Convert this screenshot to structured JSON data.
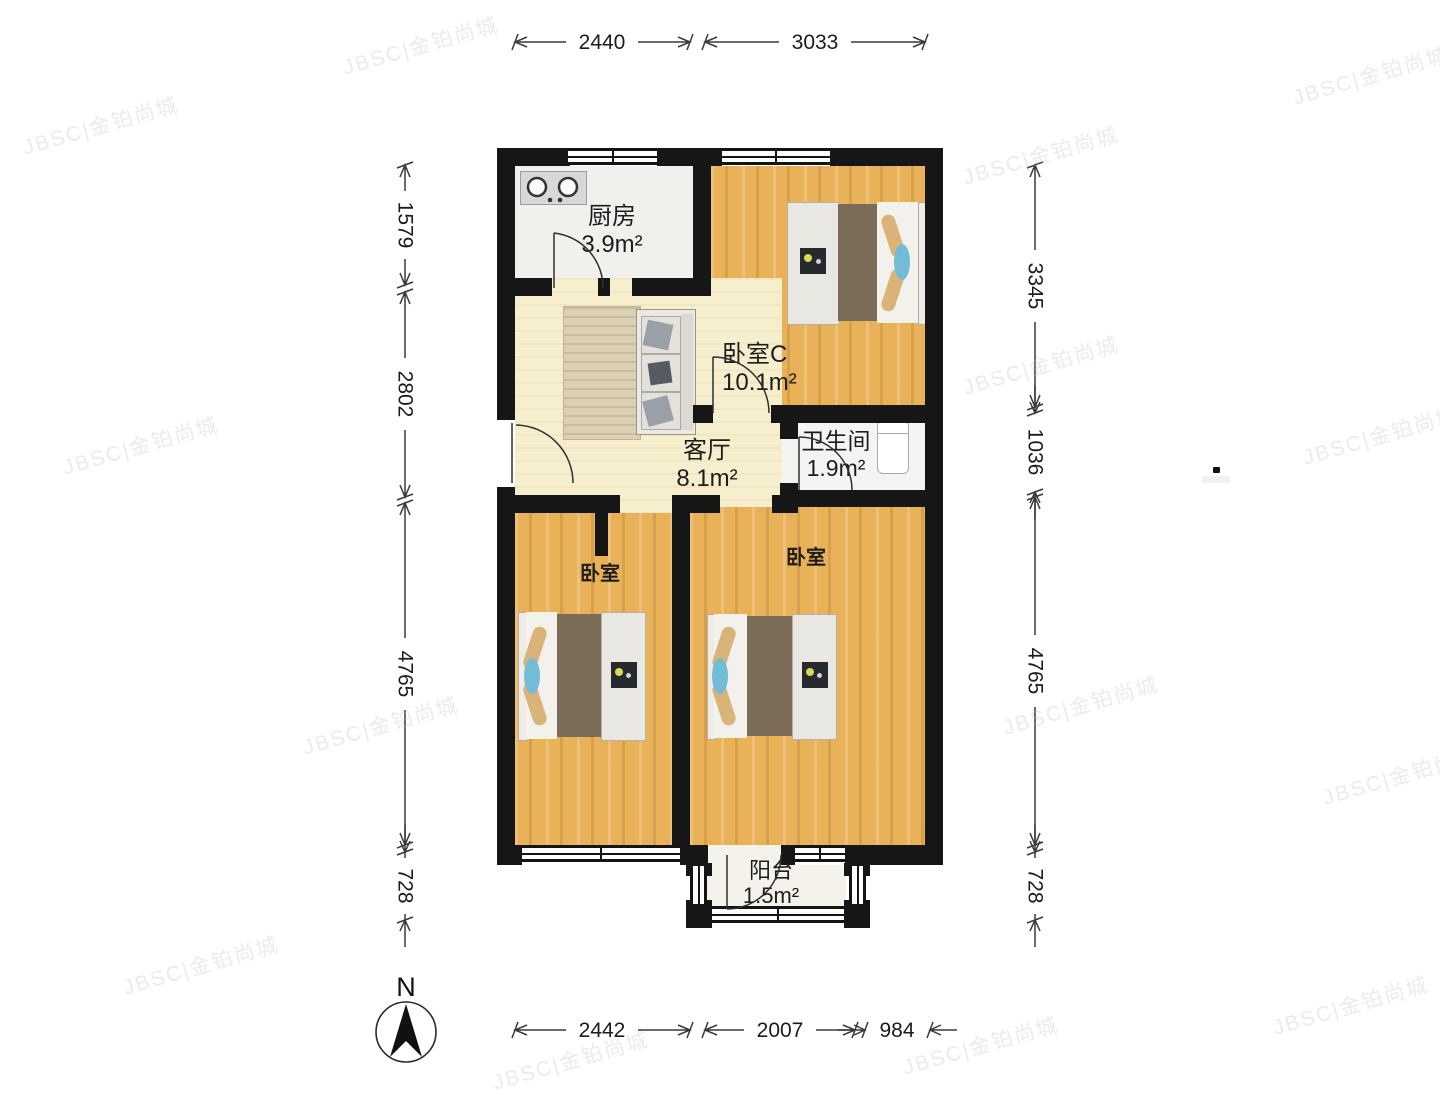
{
  "rooms": {
    "kitchen": {
      "name": "厨房",
      "area": "3.9m²"
    },
    "bedroom_c": {
      "name": "卧室C",
      "area": "10.1m²"
    },
    "living": {
      "name": "客厅",
      "area": "8.1m²"
    },
    "bathroom": {
      "name": "卫生间",
      "area": "1.9m²"
    },
    "bedroom_left": {
      "name": "卧室"
    },
    "bedroom_right": {
      "name": "卧室"
    },
    "balcony": {
      "name": "阳台",
      "area": "1.5m²"
    }
  },
  "dimensions": {
    "top": [
      "2440",
      "3033"
    ],
    "bottom": [
      "2442",
      "2007",
      "984"
    ],
    "left": [
      "1579",
      "2802",
      "4765",
      "728"
    ],
    "right": [
      "3345",
      "1036",
      "4765",
      "728"
    ]
  },
  "compass": {
    "label": "N"
  },
  "watermark": {
    "text": "JBSC|金铂尚城"
  },
  "furniture_icons": [
    "stove-icon",
    "toilet-icon",
    "double-bed",
    "sofa",
    "rug",
    "north-arrow"
  ],
  "colors": {
    "wall": "#161616",
    "wood_floor": "#e9b158",
    "living_floor": "#f7eecd",
    "blanket": "#7b6c57",
    "pillow_tan": "#d9b377",
    "pillow_cyan": "#72bcd7"
  }
}
